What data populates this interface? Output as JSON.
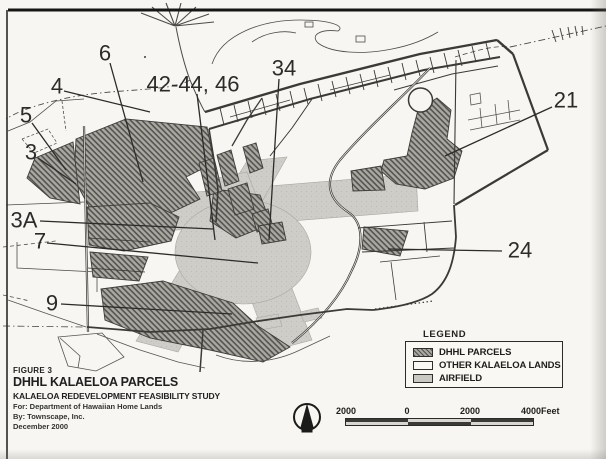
{
  "figure_block": {
    "figure_no": "FIGURE 3",
    "title": "DHHL KALAELOA PARCELS",
    "subtitle": "KALAELOA REDEVELOPMENT FEASIBILITY STUDY",
    "prepared_for": "For: Department of Hawaiian Home Lands",
    "prepared_by": "By: Townscape, Inc.",
    "date": "December 2000"
  },
  "legend": {
    "title": "LEGEND",
    "items": [
      {
        "label": "DHHL PARCELS",
        "swatch": "dhhl-hatch"
      },
      {
        "label": "OTHER KALAELOA LANDS",
        "swatch": "white"
      },
      {
        "label": "AIRFIELD",
        "swatch": "gray"
      }
    ]
  },
  "scale_bar": {
    "tick_labels": [
      "2000",
      "0",
      "2000",
      "4000"
    ],
    "unit": "Feet"
  },
  "north_arrow": {
    "icon": "north-arrow-icon"
  },
  "colors": {
    "paper": "#f7f6f2",
    "ink": "#2b2b29",
    "airfield_gray": "#cecdc8",
    "dhhl_hatch_dark": "#55534d",
    "dhhl_hatch_light": "#aaa8a2"
  },
  "map": {
    "parcel_labels": [
      {
        "text": "6",
        "x": 105,
        "y": 53,
        "leader": [
          110,
          63,
          143,
          182
        ]
      },
      {
        "text": "4",
        "x": 57,
        "y": 86,
        "leader": [
          64,
          91,
          150,
          112
        ]
      },
      {
        "text": "5",
        "x": 26,
        "y": 115,
        "leader": [
          32,
          123,
          66,
          170
        ]
      },
      {
        "text": "3",
        "x": 31,
        "y": 152,
        "leader": [
          38,
          158,
          76,
          184
        ]
      },
      {
        "text": "3A",
        "x": 24,
        "y": 220,
        "leader": [
          40,
          221,
          213,
          229
        ]
      },
      {
        "text": "7",
        "x": 40,
        "y": 241,
        "leader": [
          47,
          243,
          258,
          263
        ]
      },
      {
        "text": "9",
        "x": 52,
        "y": 303,
        "leader": [
          61,
          304,
          232,
          314
        ]
      },
      {
        "text": "42-44, 46",
        "x": 193,
        "y": 84,
        "leader": [
          197,
          94,
          215,
          240
        ]
      },
      {
        "text": "34",
        "x": 284,
        "y": 68,
        "leader": [
          279,
          79,
          269,
          240
        ]
      },
      {
        "text": "21",
        "x": 566,
        "y": 100,
        "leader": [
          552,
          107,
          445,
          156
        ]
      },
      {
        "text": "24",
        "x": 520,
        "y": 250,
        "leader": [
          502,
          251,
          388,
          249
        ]
      }
    ]
  }
}
